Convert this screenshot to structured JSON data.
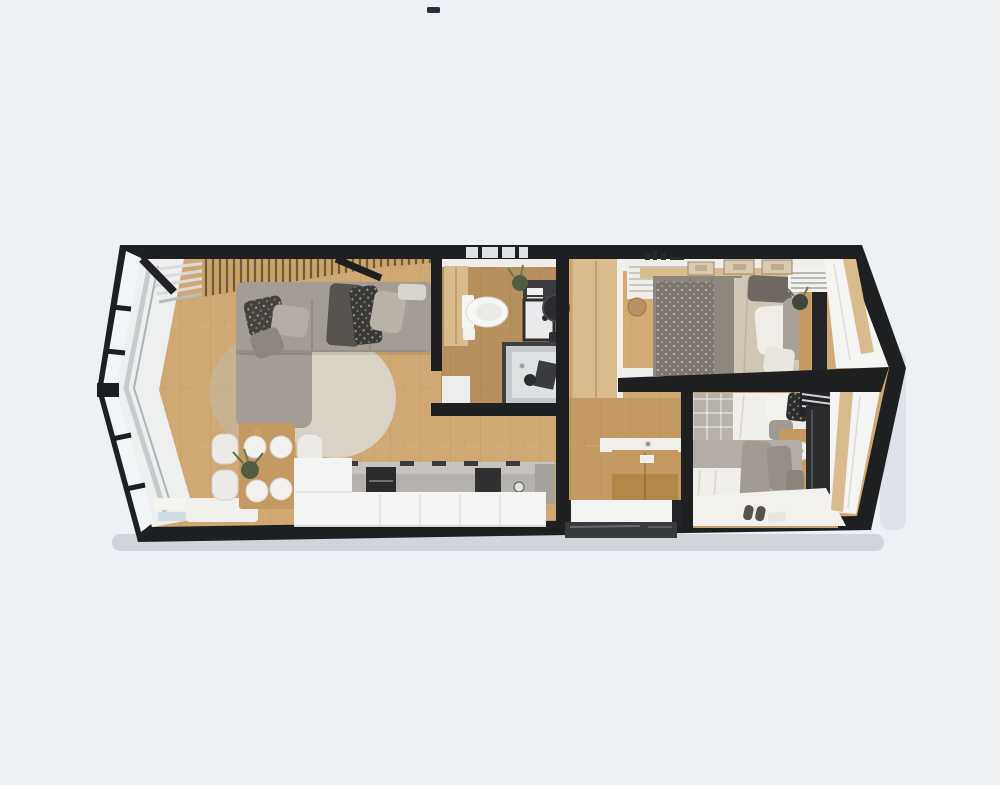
{
  "meta": {
    "description": "Top-down 3D cutaway render of an elongated hexagonal tiny-home floor plan",
    "render_type": "3d-floor-plan"
  },
  "colors": {
    "background": "#edf0f4",
    "wall": "#1e1f21",
    "floor": "#d0a873",
    "floor_bath": "#b8905e",
    "floor_hall": "#c49a64",
    "floor_bed1": "#d2aa74",
    "floor_bed2": "#c89f6a",
    "white": "#f4f4f2",
    "offwhite": "#efeeea",
    "glass": "#f2f5f8",
    "steel": "#c7cbd0",
    "sofa": "#a49d95",
    "rug_light": "#d9d3c5",
    "rug_dark": "#c6b394",
    "wood_furniture": "#c59a62",
    "wood_light": "#d9bc8e",
    "counter": "#b5b1ad",
    "appliance": "#2b2b2d",
    "duvet_gray": "#8e8780",
    "duvet_beige": "#cfc6b5",
    "bed_plaid": "#b7b2aa",
    "dark_panel": "#232427",
    "mat": "#f3f3f1",
    "mirror": "#2b2b2d",
    "plant": "#4f5e41",
    "shadow": "rgba(120,130,145,0.25)",
    "watermark": "#2b2f36"
  },
  "scene": {
    "rooms": [
      {
        "name": "living-room",
        "items": [
          "panoramic-glass-end",
          "wood-slat-ceiling",
          "corner-sofa",
          "pillows",
          "round-rugs",
          "curtain"
        ]
      },
      {
        "name": "dining-area",
        "items": [
          "wood-table",
          "four-chairs",
          "plates",
          "plant",
          "bench",
          "books"
        ]
      },
      {
        "name": "kitchen",
        "items": [
          "white-counter",
          "oven",
          "cooktop",
          "sink-knob",
          "handles"
        ]
      },
      {
        "name": "bathroom",
        "items": [
          "toilet",
          "wood-cabinet",
          "vanity",
          "sink",
          "round-mirror",
          "shower",
          "plant",
          "towels"
        ]
      },
      {
        "name": "bedroom-1",
        "items": [
          "double-bed",
          "knit-throw",
          "pillows",
          "headboard",
          "tv-panel",
          "wardrobe",
          "louver-cabinet",
          "wall-frames",
          "pouf"
        ]
      },
      {
        "name": "bedroom-2",
        "items": [
          "single-bed-top",
          "single-bed-bottom",
          "nightstand",
          "lamp",
          "wardrobe",
          "white-rug",
          "slippers",
          "window-blinds"
        ]
      },
      {
        "name": "hallway",
        "items": [
          "sideboard",
          "doormat",
          "entry-door"
        ]
      }
    ]
  }
}
